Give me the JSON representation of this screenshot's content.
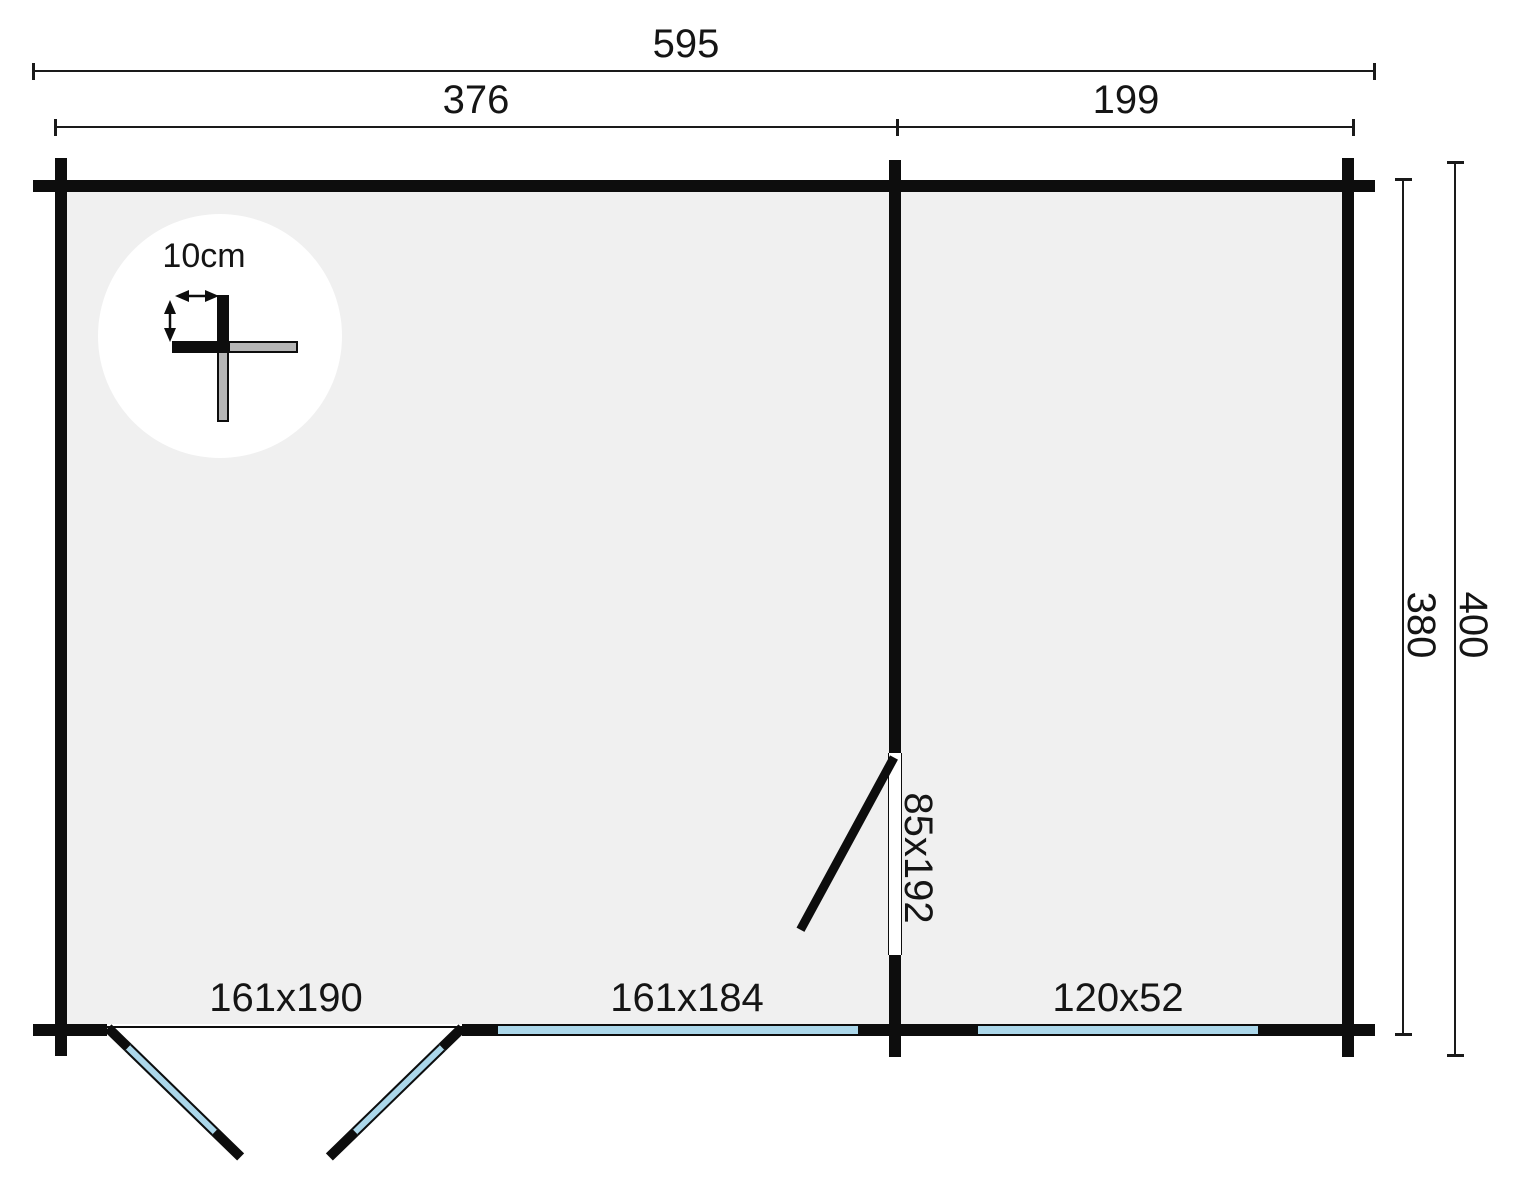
{
  "plan": {
    "dimension_labels": {
      "total_width": "595",
      "left_room_width": "376",
      "right_room_width": "199",
      "inner_depth": "380",
      "outer_depth": "400"
    },
    "opening_labels": {
      "front_double_door": "161x190",
      "front_window_large": "161x184",
      "front_window_small": "120x52",
      "interior_door": "85x192"
    },
    "corner_detail": {
      "wall_thickness": "10cm"
    },
    "colors": {
      "wall_black": "#0d0d0d",
      "floor_gray": "#f0f0f0",
      "glazing_blue": "#abd7ea",
      "log_end_gray": "#b5b5b5",
      "dimension_line": "#1a1a1a",
      "background": "#ffffff"
    }
  }
}
